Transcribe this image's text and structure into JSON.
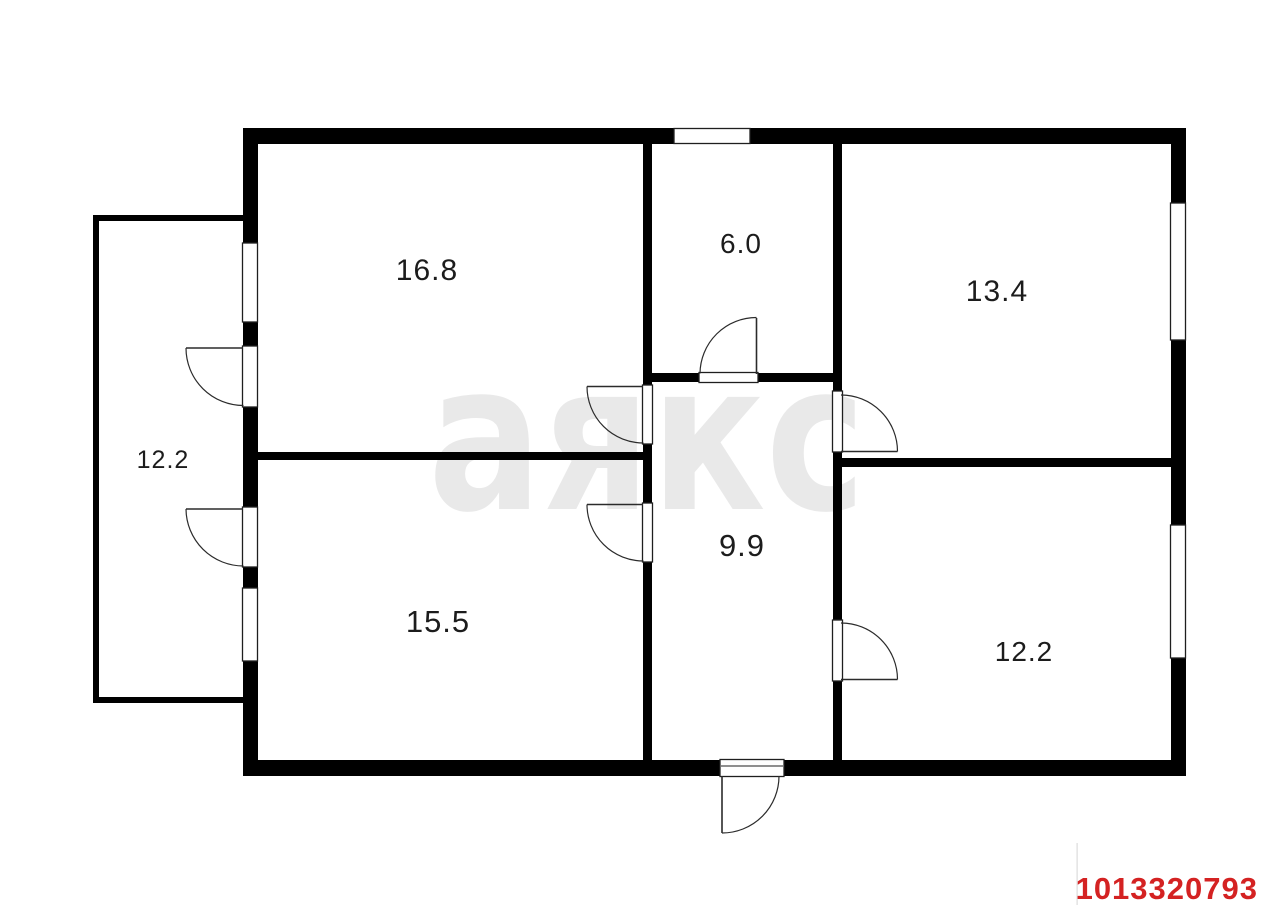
{
  "plan": {
    "background": "#ffffff",
    "wall_color": "#000000",
    "line_color": "#2b2b2b"
  },
  "watermark": {
    "text": "аякс",
    "color": "#e9e9e9"
  },
  "rooms": {
    "room_16_8": {
      "label": "16.8"
    },
    "room_6_0": {
      "label": "6.0"
    },
    "room_13_4": {
      "label": "13.4"
    },
    "room_12_2_annex": {
      "label": "12.2"
    },
    "room_9_9": {
      "label": "9.9"
    },
    "room_15_5": {
      "label": "15.5"
    },
    "room_12_2_right": {
      "label": "12.2"
    }
  },
  "footer": {
    "listing_id": "1013320793",
    "color": "#d42222"
  }
}
